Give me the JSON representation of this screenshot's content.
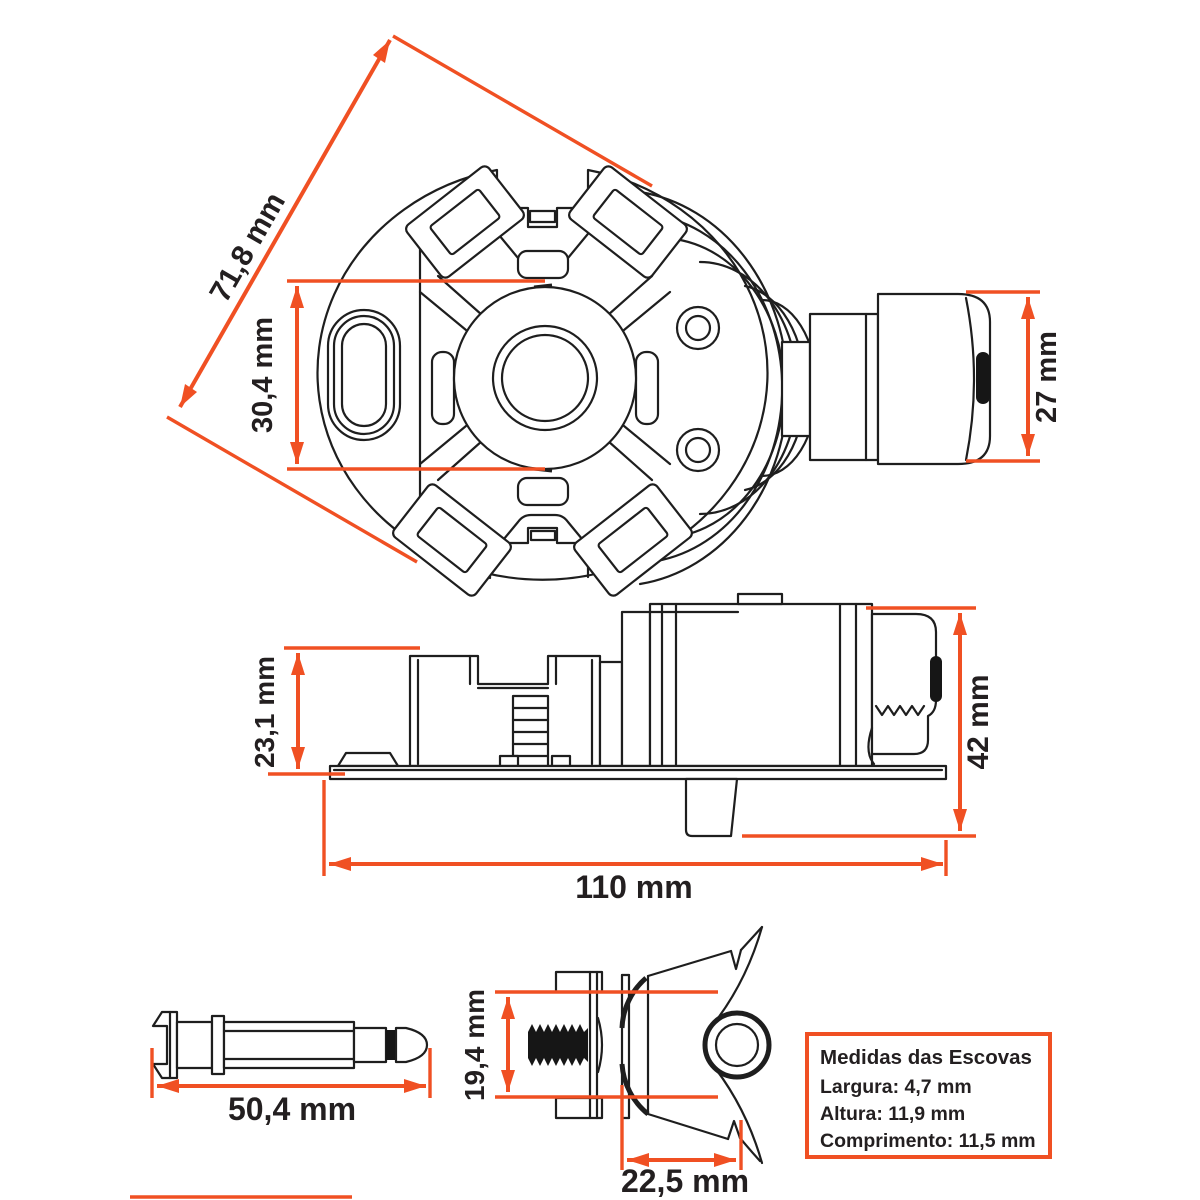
{
  "colors": {
    "accent": "#F05023",
    "line": "#1E1E1E",
    "text": "#231F20"
  },
  "dims": {
    "top_diagonal": "71,8 mm",
    "top_center_height": "30,4 mm",
    "connector_diameter": "27 mm",
    "side_height": "23,1 mm",
    "side_total_height": "42 mm",
    "side_length": "110 mm",
    "pin_length": "50,4 mm",
    "brush_detail_height": "19,4 mm",
    "brush_detail_width": "22,5 mm"
  },
  "info_box": {
    "title": "Medidas das Escovas",
    "lines": [
      "Largura: 4,7 mm",
      "Altura: 11,9 mm",
      "Comprimento: 11,5 mm"
    ]
  }
}
